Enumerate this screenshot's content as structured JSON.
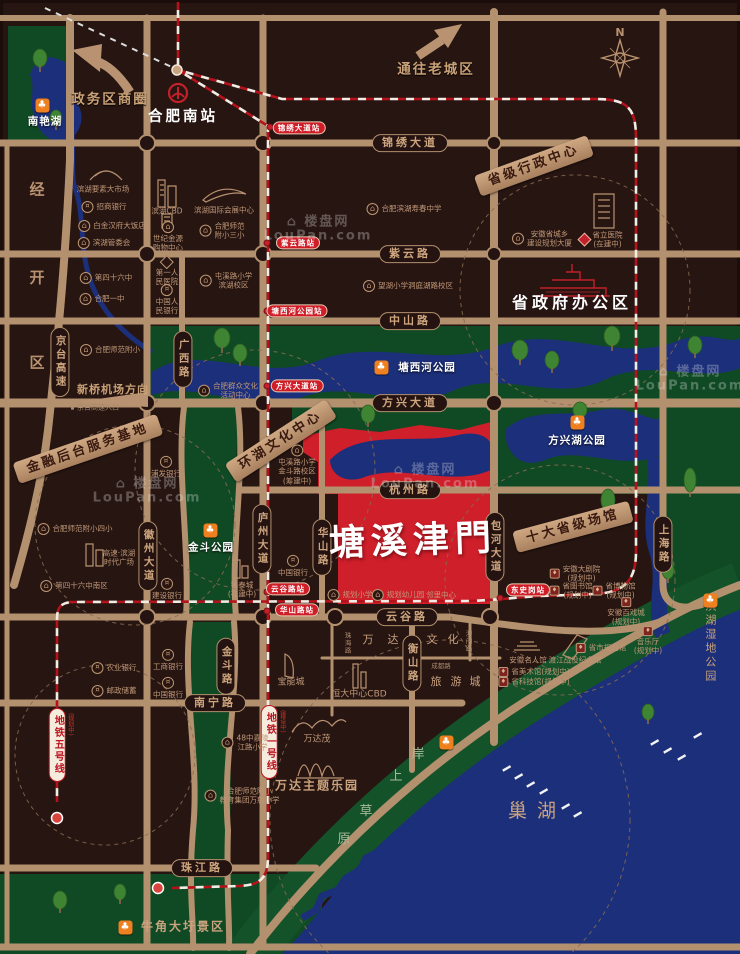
{
  "meta": {
    "project_name": "塘溪津門",
    "compass": "N",
    "watermark_brand": "楼盘网",
    "watermark_domain": "LouPan.com",
    "colors": {
      "background": "#271511",
      "road": "#b3906e",
      "green": "#14522a",
      "water": "#1c2f7a",
      "project_red": "#cf1f2b",
      "metro_red": "#b5121b",
      "park_icon_orange": "#ef8020",
      "station_pill_red": "#cf1e28",
      "text_tan": "#c9a27e"
    }
  },
  "labels": [
    {
      "cls": "rh",
      "t": "锦绣大道",
      "x": 410,
      "y": 143,
      "n": "road-label-jinxiu-avenue"
    },
    {
      "cls": "rh",
      "t": "紫云路",
      "x": 410,
      "y": 254,
      "n": "road-label-ziyun-road"
    },
    {
      "cls": "rh",
      "t": "中山路",
      "x": 410,
      "y": 321,
      "n": "road-label-zhongshan-road"
    },
    {
      "cls": "rh",
      "t": "方兴大道",
      "x": 410,
      "y": 403,
      "n": "road-label-fangxing-avenue"
    },
    {
      "cls": "rh",
      "t": "杭州路",
      "x": 410,
      "y": 490,
      "n": "road-label-hangzhou-road"
    },
    {
      "cls": "rh",
      "t": "云谷路",
      "x": 407,
      "y": 617,
      "n": "road-label-yungu-road"
    },
    {
      "cls": "rh",
      "t": "南宁路",
      "x": 215,
      "y": 703,
      "n": "road-label-nanning-road"
    },
    {
      "cls": "rh",
      "t": "珠江路",
      "x": 202,
      "y": 868,
      "n": "road-label-zhujiang-road"
    },
    {
      "cls": "rv",
      "t": "京台高速",
      "x": 60,
      "y": 362,
      "n": "road-label-jingtai-expressway"
    },
    {
      "cls": "rv",
      "t": "广西路",
      "x": 183,
      "y": 359,
      "n": "road-label-guangxi-road"
    },
    {
      "cls": "rv",
      "t": "徽州大道",
      "x": 148,
      "y": 556,
      "n": "road-label-huizhou-avenue"
    },
    {
      "cls": "rv",
      "t": "庐州大道",
      "x": 262,
      "y": 539,
      "n": "road-label-luzhou-avenue"
    },
    {
      "cls": "rv",
      "t": "华山路",
      "x": 322,
      "y": 547,
      "n": "road-label-huashan-road"
    },
    {
      "cls": "rv",
      "t": "包河大道",
      "x": 495,
      "y": 547,
      "n": "road-label-baohe-avenue"
    },
    {
      "cls": "rv",
      "t": "上海路",
      "x": 663,
      "y": 544,
      "n": "road-label-shanghai-road"
    },
    {
      "cls": "rv",
      "t": "衡山路",
      "x": 412,
      "y": 663,
      "n": "road-label-hengshan-road"
    },
    {
      "cls": "rv",
      "t": "金斗路",
      "x": 226,
      "y": 666,
      "n": "road-label-jindou-road"
    },
    {
      "cls": "st",
      "t": "锦绣大道站",
      "x": 299,
      "y": 128,
      "n": "station-jinxiu-avenue"
    },
    {
      "cls": "st",
      "t": "紫云路站",
      "x": 298,
      "y": 243,
      "n": "station-ziyun-road"
    },
    {
      "cls": "st",
      "t": "塘西河公园站",
      "x": 297,
      "y": 311,
      "n": "station-tangxihe-park"
    },
    {
      "cls": "st",
      "t": "方兴大道站",
      "x": 297,
      "y": 386,
      "n": "station-fangxing-avenue"
    },
    {
      "cls": "st",
      "t": "云谷路站",
      "x": 288,
      "y": 589,
      "n": "station-yungu-road"
    },
    {
      "cls": "st",
      "t": "华山路站",
      "x": 297,
      "y": 610,
      "n": "station-huashan-road"
    },
    {
      "cls": "st",
      "t": "东史岗站",
      "x": 528,
      "y": 590,
      "n": "station-dongshigang"
    },
    {
      "cls": "ml",
      "t": "地铁五号线",
      "note": "(规划中)",
      "x": 57,
      "y": 745,
      "n": "metro-line-5-label"
    },
    {
      "cls": "ml",
      "t": "地铁一号线",
      "note": "(建设中)",
      "x": 269,
      "y": 742,
      "n": "metro-line-1-label"
    },
    {
      "cls": "bn",
      "t": "金融后台服务基地",
      "x": 88,
      "y": 449,
      "rot": -19,
      "n": "banner-financial-base"
    },
    {
      "cls": "bn",
      "t": "环湖文化中心",
      "x": 281,
      "y": 441,
      "rot": -33,
      "n": "banner-lakeside-culture-center"
    },
    {
      "cls": "bn",
      "t": "省级行政中心",
      "x": 534,
      "y": 166,
      "rot": -20,
      "n": "banner-provincial-admin-center"
    },
    {
      "cls": "bn",
      "t": "十大省级场馆",
      "x": 573,
      "y": 527,
      "rot": -15,
      "n": "banner-ten-provincial-venues"
    },
    {
      "cls": "t-shangquan",
      "t": "政务区商圈",
      "x": 110,
      "y": 100,
      "n": "title-zhengwu-district"
    },
    {
      "cls": "t-shangquan",
      "t": "通往老城区",
      "x": 436,
      "y": 70,
      "n": "title-to-old-town"
    },
    {
      "cls": "t-station-big",
      "t": "合肥南站",
      "x": 183,
      "y": 117,
      "n": "title-hefei-south-station"
    },
    {
      "cls": "t-gov",
      "t": "省政府办公区",
      "x": 572,
      "y": 303,
      "n": "title-provincial-government"
    },
    {
      "cls": "t-logo",
      "t": "塘溪津門",
      "x": 413,
      "y": 541,
      "n": "project-logo"
    },
    {
      "cls": "t-lake",
      "t": "巢湖",
      "x": 537,
      "y": 812,
      "n": "title-chao-lake"
    },
    {
      "cls": "t-airport",
      "t": "新桥机场方向",
      "x": 113,
      "y": 390,
      "n": "title-xinqiao-airport-direction"
    },
    {
      "cls": "t-tiny",
      "t": "京台高速入口",
      "x": 95,
      "y": 408,
      "icon": "dot",
      "n": "title-jingtai-entrance"
    },
    {
      "cls": "t-wet",
      "t": "滨湖湿地公园",
      "x": 710,
      "y": 642,
      "n": "title-binhu-wetland-park"
    },
    {
      "cls": "t-compass",
      "t": "N",
      "x": 620,
      "y": 33,
      "n": "compass-n"
    },
    {
      "cls": "ch-d",
      "t": "经",
      "x": 37,
      "y": 190,
      "n": "district-char-jing"
    },
    {
      "cls": "ch-d",
      "t": "开",
      "x": 37,
      "y": 278,
      "n": "district-char-kai"
    },
    {
      "cls": "ch-d",
      "t": "区",
      "x": 37,
      "y": 363,
      "n": "district-char-qu"
    },
    {
      "cls": "ch-s",
      "t": "岸",
      "x": 418,
      "y": 755,
      "n": "shore-char-an"
    },
    {
      "cls": "ch-s",
      "t": "上",
      "x": 396,
      "y": 777,
      "n": "shore-char-shang"
    },
    {
      "cls": "ch-s",
      "t": "草",
      "x": 366,
      "y": 812,
      "n": "shore-char-cao"
    },
    {
      "cls": "ch-s",
      "t": "原",
      "x": 344,
      "y": 840,
      "n": "shore-char-yuan"
    },
    {
      "cls": "ch-w",
      "t": "万",
      "x": 368,
      "y": 640,
      "n": "wanda-char"
    },
    {
      "cls": "ch-w",
      "t": "达",
      "x": 393,
      "y": 640,
      "n": "wanda-char"
    },
    {
      "cls": "ch-w",
      "t": "文",
      "x": 432,
      "y": 640,
      "n": "wanda-char"
    },
    {
      "cls": "ch-w",
      "t": "化",
      "x": 453,
      "y": 640,
      "n": "wanda-char"
    },
    {
      "cls": "ch-w",
      "t": "旅",
      "x": 436,
      "y": 682,
      "n": "wanda-char"
    },
    {
      "cls": "ch-w",
      "t": "游",
      "x": 456,
      "y": 682,
      "n": "wanda-char"
    },
    {
      "cls": "ch-w",
      "t": "城",
      "x": 475,
      "y": 682,
      "n": "wanda-char"
    },
    {
      "cls": "tr",
      "t": "成都路",
      "x": 441,
      "y": 666,
      "n": "road-label-chengdu-road"
    },
    {
      "cls": "trv",
      "t": "珠海路",
      "x": 347,
      "y": 643,
      "n": "road-label-zhuhai-road"
    },
    {
      "cls": "trv",
      "t": "澳门路",
      "x": 468,
      "y": 641,
      "n": "road-label-aomen-road"
    },
    {
      "cls": "pw",
      "t": "南艳湖",
      "x": 45,
      "y": 122,
      "n": "park-label-nanyan-lake"
    },
    {
      "cls": "pw",
      "t": "塘西河公园",
      "x": 427,
      "y": 368,
      "n": "park-label-tangxihe-park"
    },
    {
      "cls": "pw",
      "t": "方兴湖公园",
      "x": 577,
      "y": 441,
      "n": "park-label-fangxing-lake-park"
    },
    {
      "cls": "pw",
      "t": "金斗公园",
      "x": 211,
      "y": 548,
      "n": "park-label-jindou-park"
    },
    {
      "cls": "t-tan-md",
      "t": "牛角大圩景区",
      "x": 183,
      "y": 927,
      "n": "park-label-niujiaodawei"
    },
    {
      "cls": "pico",
      "t": "",
      "x": 42,
      "y": 105,
      "icon": "park",
      "n": "park-icon-nanyan-lake"
    },
    {
      "cls": "pico",
      "t": "",
      "x": 381,
      "y": 367,
      "icon": "park",
      "n": "park-icon-tangxihe"
    },
    {
      "cls": "pico",
      "t": "",
      "x": 577,
      "y": 422,
      "icon": "park",
      "n": "park-icon-fangxing-lake"
    },
    {
      "cls": "pico",
      "t": "",
      "x": 210,
      "y": 530,
      "icon": "park",
      "n": "park-icon-jindou"
    },
    {
      "cls": "pico",
      "t": "",
      "x": 710,
      "y": 600,
      "icon": "park",
      "n": "park-icon-wetland"
    },
    {
      "cls": "pico",
      "t": "",
      "x": 125,
      "y": 927,
      "icon": "park",
      "n": "park-icon-niujiaodawei"
    },
    {
      "cls": "pico",
      "t": "",
      "x": 446,
      "y": 742,
      "icon": "park",
      "n": "park-icon-lakeshore"
    },
    {
      "cls": "poi",
      "t": "滨湖要素大市场",
      "x": 103,
      "y": 189,
      "n": "poi-binhu-market"
    },
    {
      "cls": "poi",
      "t": "招商银行",
      "x": 104,
      "y": 207,
      "icon": "bank",
      "n": "poi-cmb-bank"
    },
    {
      "cls": "poi",
      "t": "白金汉府大饭店",
      "x": 112,
      "y": 226,
      "icon": "bld",
      "n": "poi-baijinhanfu-hotel"
    },
    {
      "cls": "poi",
      "t": "滨湖管委会",
      "x": 104,
      "y": 243,
      "icon": "bld",
      "n": "poi-binhu-committee"
    },
    {
      "cls": "poi",
      "t": "第四十六中",
      "x": 106,
      "y": 278,
      "icon": "bld",
      "n": "poi-no46-middle-school"
    },
    {
      "cls": "poi",
      "t": "合肥一中",
      "x": 102,
      "y": 299,
      "icon": "bld",
      "n": "poi-hefei-no1-high-school"
    },
    {
      "cls": "poi",
      "t": "合肥师范附小",
      "x": 110,
      "y": 350,
      "icon": "bld",
      "n": "poi-normal-primary"
    },
    {
      "cls": "poi",
      "t": "合肥师范附小四小",
      "x": 75,
      "y": 529,
      "icon": "bld",
      "n": "poi-normal-primary-4"
    },
    {
      "cls": "poi",
      "t": "高速·滨湖\n时代广场",
      "x": 119,
      "y": 558,
      "n": "poi-gaosu-times-square"
    },
    {
      "cls": "poi",
      "t": "第四十六中南区",
      "x": 74,
      "y": 586,
      "icon": "bld",
      "n": "poi-no46-south"
    },
    {
      "cls": "poi",
      "t": "农业银行",
      "x": 114,
      "y": 668,
      "icon": "bank",
      "n": "poi-abc-bank"
    },
    {
      "cls": "poi",
      "t": "邮政储蓄",
      "x": 114,
      "y": 691,
      "icon": "bank",
      "n": "poi-postal-savings"
    },
    {
      "cls": "pst",
      "t": "滨湖CBD",
      "x": 167,
      "y": 211,
      "n": "poi-binhu-cbd"
    },
    {
      "cls": "pst",
      "t": "世纪金源\n购物中心",
      "x": 168,
      "y": 237,
      "icon": "bld",
      "n": "poi-shijijinyuan-mall"
    },
    {
      "cls": "pst",
      "t": "第一人\n民医院",
      "x": 167,
      "y": 272,
      "icon": "hosp",
      "n": "poi-first-peoples-hospital"
    },
    {
      "cls": "pst",
      "t": "中国人\n民银行",
      "x": 167,
      "y": 300,
      "icon": "bank",
      "n": "poi-pboc-bank"
    },
    {
      "cls": "pst",
      "t": "浦发银行",
      "x": 166,
      "y": 467,
      "icon": "bank",
      "n": "poi-spd-bank"
    },
    {
      "cls": "pst",
      "t": "建设银行",
      "x": 167,
      "y": 589,
      "icon": "bank",
      "n": "poi-ccb-bank"
    },
    {
      "cls": "pst",
      "t": "工商银行",
      "x": 168,
      "y": 660,
      "icon": "bank",
      "n": "poi-icbc-bank"
    },
    {
      "cls": "pst",
      "t": "中国银行",
      "x": 168,
      "y": 688,
      "icon": "bank",
      "n": "poi-boc-bank"
    },
    {
      "cls": "poi",
      "t": "滨湖国际会展中心",
      "x": 224,
      "y": 210,
      "n": "poi-intl-expo-center"
    },
    {
      "cls": "poi",
      "t": "合肥师范\n附小三小",
      "x": 222,
      "y": 231,
      "icon": "bld",
      "n": "poi-normal-primary-3"
    },
    {
      "cls": "poi",
      "t": "屯溪路小学\n滨湖校区",
      "x": 226,
      "y": 281,
      "icon": "bld",
      "n": "poi-tunxilu-primary-binhu"
    },
    {
      "cls": "poi",
      "t": "合肥群众文化\n活动中心",
      "x": 228,
      "y": 391,
      "icon": "bld",
      "n": "poi-mass-culture-center"
    },
    {
      "cls": "pst",
      "t": "银泰城\n(在建中)",
      "x": 242,
      "y": 590,
      "n": "poi-yintai-city"
    },
    {
      "cls": "poi",
      "t": "合肥滨湖寿春中学",
      "x": 404,
      "y": 209,
      "icon": "bld",
      "n": "poi-shouchun-middle-school"
    },
    {
      "cls": "poi",
      "t": "望湖小学洞庭湖路校区",
      "x": 408,
      "y": 286,
      "icon": "bld",
      "n": "poi-wanghu-primary"
    },
    {
      "cls": "poi",
      "t": "安徽省城乡\n建设规划大厦",
      "x": 542,
      "y": 239,
      "icon": "bld",
      "n": "poi-planning-tower"
    },
    {
      "cls": "poi",
      "t": "省立医院\n(在建中)",
      "x": 601,
      "y": 240,
      "icon": "hospr",
      "n": "poi-provincial-hospital"
    },
    {
      "cls": "pst",
      "t": "屯溪路小学\n金斗路校区\n(筹建中)",
      "x": 297,
      "y": 465,
      "icon": "bld",
      "n": "poi-tunxilu-primary-jindou"
    },
    {
      "cls": "pst",
      "t": "中国银行",
      "x": 293,
      "y": 566,
      "icon": "bank",
      "n": "poi-boc-bank-2"
    },
    {
      "cls": "poi",
      "t": "规划小学",
      "x": 350,
      "y": 595,
      "icon": "bld",
      "n": "poi-planned-primary"
    },
    {
      "cls": "poi",
      "t": "规划幼儿园",
      "x": 398,
      "y": 595,
      "icon": "bld",
      "n": "poi-planned-kindergarten"
    },
    {
      "cls": "poi",
      "t": "邻里中心",
      "x": 441,
      "y": 595,
      "n": "poi-neighborhood-center"
    },
    {
      "cls": "poi",
      "t": "安徽大剧院\n(规划中)",
      "x": 575,
      "y": 574,
      "icon": "ven",
      "n": "poi-anhui-grand-theatre"
    },
    {
      "cls": "poi",
      "t": "省图书馆\n(规划中)",
      "x": 571,
      "y": 591,
      "icon": "ven",
      "n": "poi-provincial-library"
    },
    {
      "cls": "poi",
      "t": "省博物馆\n(规划中)",
      "x": 614,
      "y": 591,
      "icon": "ven",
      "n": "poi-provincial-museum"
    },
    {
      "cls": "pst",
      "t": "安徽百戏城\n(规划中)",
      "x": 626,
      "y": 612,
      "icon": "ven",
      "n": "poi-baixi-city"
    },
    {
      "cls": "pst",
      "t": "音乐厅\n(规划中)",
      "x": 648,
      "y": 641,
      "icon": "ven",
      "n": "poi-concert-hall"
    },
    {
      "cls": "poi",
      "t": "省市规划馆",
      "x": 601,
      "y": 648,
      "icon": "ven",
      "n": "poi-planning-exhibition-hall"
    },
    {
      "cls": "poi",
      "t": "渡江战役纪念馆",
      "x": 575,
      "y": 660,
      "n": "poi-dujiang-memorial"
    },
    {
      "cls": "poi",
      "t": "安徽名人馆",
      "x": 528,
      "y": 660,
      "n": "poi-anhui-celebrity-hall"
    },
    {
      "cls": "poi",
      "t": "省美术馆(规划中)",
      "x": 534,
      "y": 672,
      "icon": "ven",
      "n": "poi-provincial-art-museum"
    },
    {
      "cls": "poi",
      "t": "省科技馆(规划中)",
      "x": 534,
      "y": 682,
      "icon": "ven",
      "n": "poi-provincial-science-museum"
    },
    {
      "cls": "poi",
      "t": "48中嘉陵\n江路小学",
      "x": 245,
      "y": 743,
      "icon": "bld",
      "n": "poi-no48-jialing-primary"
    },
    {
      "cls": "poi",
      "t": "合肥师范附小\n教育集团万慈小学",
      "x": 242,
      "y": 796,
      "icon": "bld",
      "n": "poi-wanci-primary"
    },
    {
      "cls": "t-tan-sm",
      "t": "宝能城",
      "x": 291,
      "y": 683,
      "n": "poi-baoneng-city"
    },
    {
      "cls": "t-tan-sm",
      "t": "恒大中心CBD",
      "x": 359,
      "y": 695,
      "n": "poi-hengda-center-cbd"
    },
    {
      "cls": "t-tan-sm",
      "t": "万达茂",
      "x": 317,
      "y": 740,
      "n": "poi-wanda-mao"
    },
    {
      "cls": "t-tan-md",
      "t": "万达主题乐园",
      "x": 317,
      "y": 786,
      "n": "poi-wanda-theme-park"
    },
    {
      "cls": "wm",
      "t": "⌂ 楼盘网\nLouPan.com",
      "x": 318,
      "y": 230,
      "n": "watermark"
    },
    {
      "cls": "wm",
      "t": "⌂ 楼盘网\nLouPan.com",
      "x": 425,
      "y": 478,
      "n": "watermark"
    },
    {
      "cls": "wm",
      "t": "⌂ 楼盘网\nLouPan.com",
      "x": 147,
      "y": 492,
      "n": "watermark"
    },
    {
      "cls": "wm",
      "t": "⌂ 楼盘网\nLouPan.com",
      "x": 690,
      "y": 380,
      "n": "watermark"
    }
  ]
}
